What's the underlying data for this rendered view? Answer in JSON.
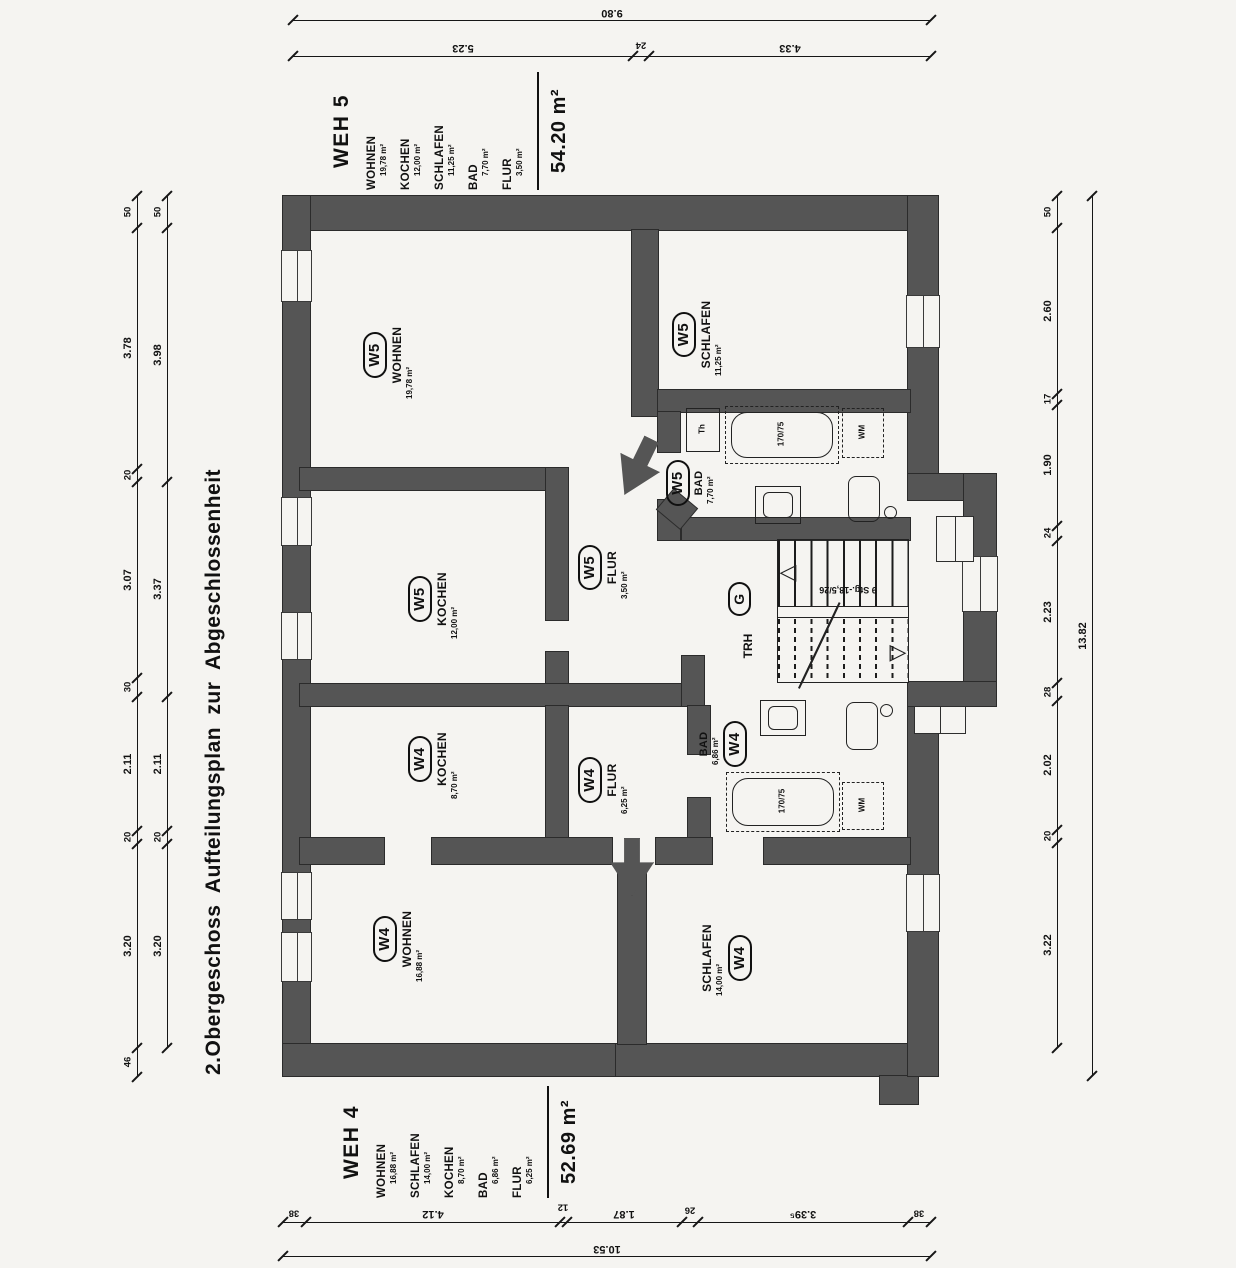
{
  "title": "2.Obergeschoss Aufteilungsplan zur Abgeschlossenheit",
  "weh5": {
    "name": "WEH 5",
    "tag": "W5",
    "total": "54.20 m²",
    "rooms": {
      "wohnen": {
        "label": "WOHNEN",
        "area": "19,78 m²"
      },
      "kochen": {
        "label": "KOCHEN",
        "area": "12,00 m²"
      },
      "schlafen": {
        "label": "SCHLAFEN",
        "area": "11,25 m²"
      },
      "bad": {
        "label": "BAD",
        "area": "7,70 m²"
      },
      "flur": {
        "label": "FLUR",
        "area": "3,50 m²"
      }
    }
  },
  "weh4": {
    "name": "WEH 4",
    "tag": "W4",
    "total": "52.69 m²",
    "rooms": {
      "wohnen": {
        "label": "WOHNEN",
        "area": "16,88 m²"
      },
      "schlafen": {
        "label": "SCHLAFEN",
        "area": "14,00 m²"
      },
      "kochen": {
        "label": "KOCHEN",
        "area": "8,70 m²"
      },
      "bad": {
        "label": "BAD",
        "area": "6,86 m²"
      },
      "flur": {
        "label": "FLUR",
        "area": "6,25 m²"
      }
    }
  },
  "stairwell": {
    "tag": "G",
    "hall": "TRH",
    "note": "9 Stg.-18,5/26"
  },
  "fixtures": {
    "bathtub": "170/75",
    "washing_machine": "WM",
    "boiler": "Th"
  },
  "dims": {
    "top_total": "9.80",
    "top": [
      "5.23",
      "24",
      "4.33"
    ],
    "bottom": [
      "38",
      "4.12",
      "12",
      "1.87",
      "26",
      "3.39⁵",
      "38"
    ],
    "bottom_total": "10.53",
    "left_outer": [
      "50",
      "3.78",
      "20",
      "3.07",
      "30",
      "2.11",
      "20",
      "3.20",
      "46"
    ],
    "left_inner": [
      "50",
      "3.98",
      "3.37",
      "2.11",
      "20",
      "3.20"
    ],
    "right": [
      "50",
      "2.60",
      "17",
      "1.90",
      "24",
      "2.23",
      "28",
      "2.02",
      "20",
      "3.22"
    ],
    "right_total": "13.82"
  }
}
